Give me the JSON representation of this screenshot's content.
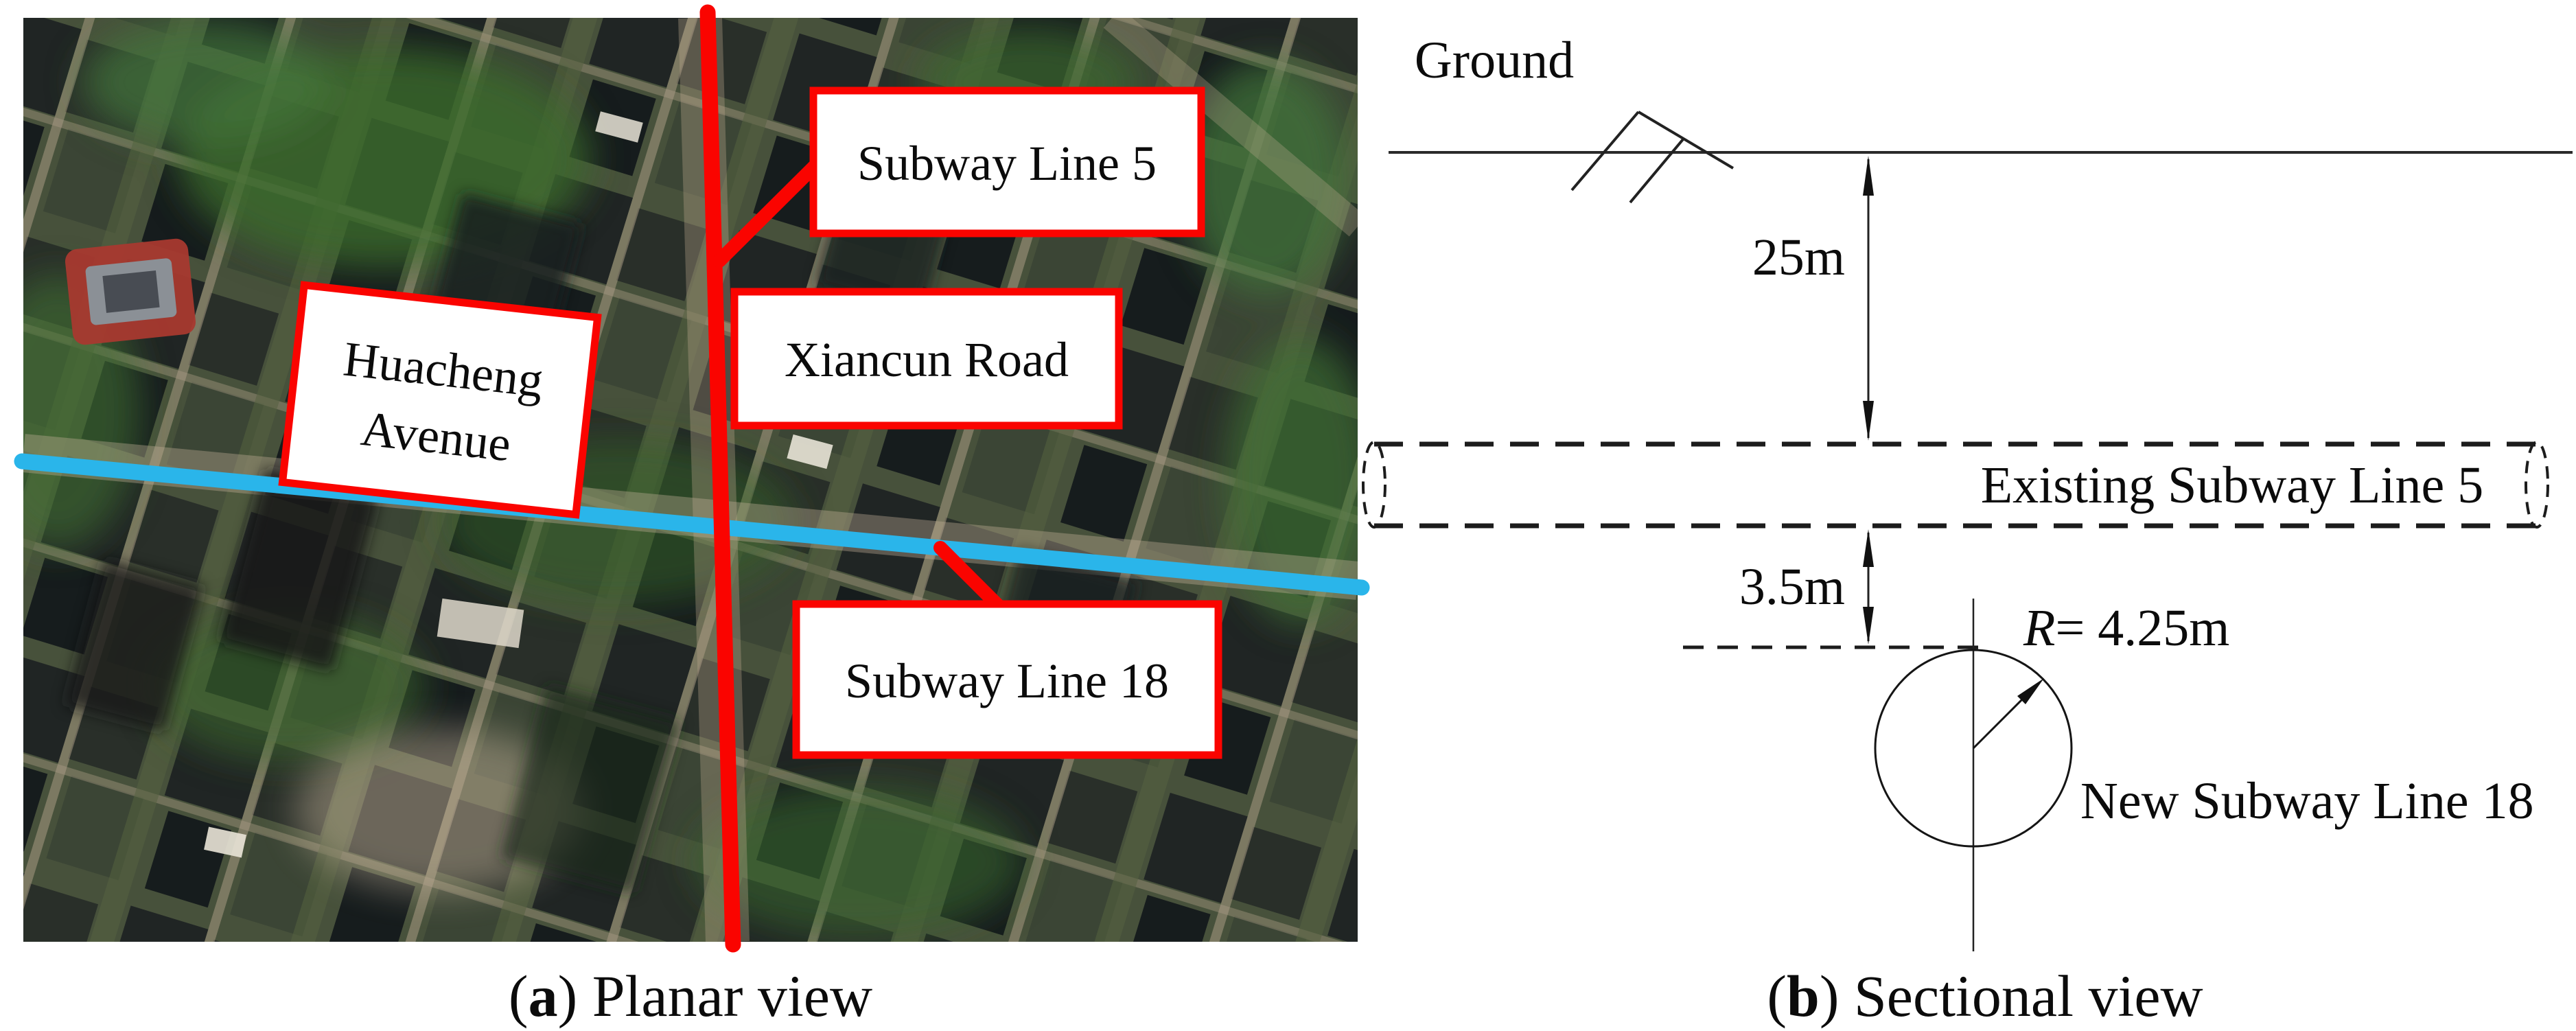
{
  "colors": {
    "line5_red": "#fa0400",
    "line18_blue": "#2ab5ea",
    "box_border_red": "#fa0400",
    "ink": "#1a1a1a"
  },
  "panel_a": {
    "labels": {
      "subway_line_5": "Subway Line 5",
      "xiancun_road": "Xiancun Road",
      "huacheng_line1": "Huacheng",
      "huacheng_line2": "Avenue",
      "subway_line_18": "Subway Line 18"
    },
    "caption": {
      "prefix": "(",
      "letter": "a",
      "rest": ") Planar view"
    }
  },
  "panel_b": {
    "labels": {
      "ground": "Ground",
      "depth": "25m",
      "existing": "Existing Subway Line 5",
      "clearance": "3.5m",
      "radius_symbol": "R",
      "radius_value": "= 4.25m",
      "new_line": "New Subway Line 18"
    },
    "caption": {
      "prefix": "(",
      "letter": "b",
      "rest": ") Sectional view"
    }
  }
}
